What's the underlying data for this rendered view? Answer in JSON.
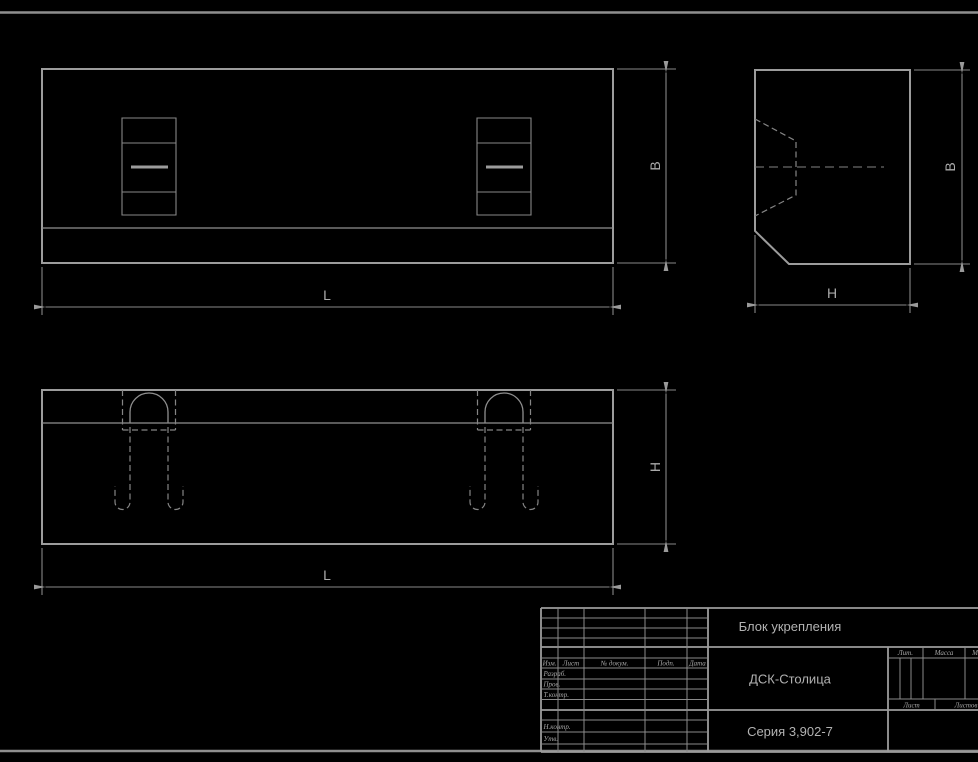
{
  "canvas": {
    "background": "#000000",
    "outline_color": "#9c9c9c",
    "thin_line_color": "#878787",
    "text_color": "#aaaaaa"
  },
  "views": {
    "plan": {
      "dim_length": "L",
      "dim_width": "В"
    },
    "side": {
      "dim_depth": "H",
      "dim_width": "В"
    },
    "front": {
      "dim_length": "L",
      "dim_height": "H"
    }
  },
  "title_block": {
    "title": "Блок укрепления",
    "organization": "ДСК-Столица",
    "series": "Серия 3,902-7",
    "header_cols": [
      "Изм.",
      "Лист",
      "№ докум.",
      "Подп.",
      "Дата"
    ],
    "rows": [
      "Разраб.",
      "Пров.",
      "Т.контр.",
      "Н.контр.",
      "Утв."
    ],
    "right_headers": [
      "Лит.",
      "Масса",
      "Масштаб"
    ],
    "sheet_labels": [
      "Лист",
      "Листов"
    ]
  }
}
